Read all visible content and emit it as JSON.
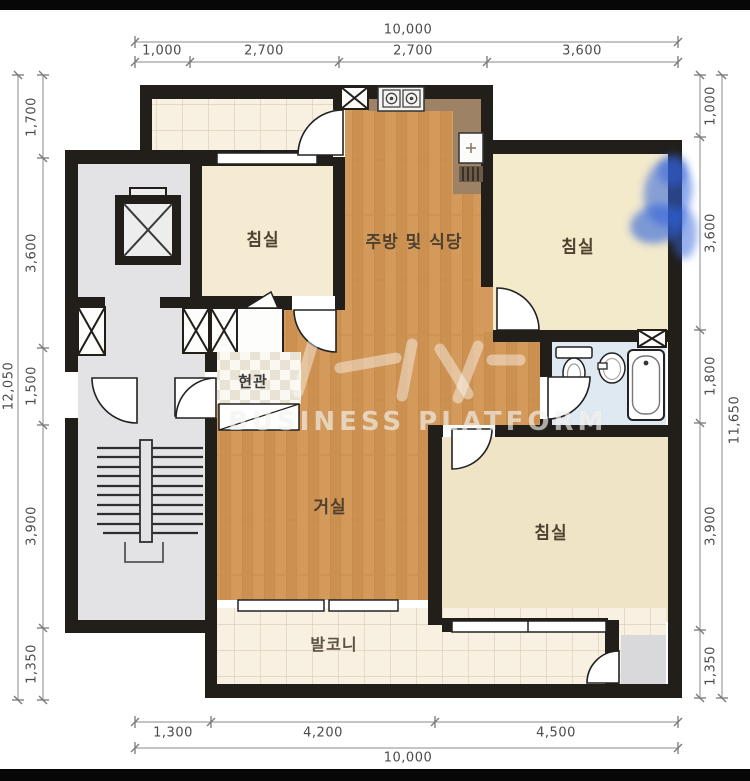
{
  "plan": {
    "rooms": {
      "bedroom_top_left": "침실",
      "bedroom_top_right": "침실",
      "bedroom_bottom_right": "침실",
      "kitchen": "주방 및 식당",
      "entrance": "현관",
      "living": "거실",
      "balcony": "발코니"
    },
    "watermark": "BUSINESS PLATFORM",
    "colors": {
      "wall": "#221e1a",
      "wood_floor": "#d49a5b",
      "bedroom_floor": "#f4ebd2",
      "balcony_tile": "#f8f1e2",
      "bath_floor": "#dfe9f1",
      "corridor": "#e3e3e5",
      "counter": "#9d8266",
      "annotation_blue": "#2f62dc"
    }
  },
  "dimensions": {
    "top": {
      "total": "10,000",
      "segments": [
        "1,000",
        "2,700",
        "2,700",
        "3,600"
      ]
    },
    "left": {
      "total": "12,050",
      "segments": [
        "1,700",
        "3,600",
        "1,500",
        "3,900",
        "1,350"
      ]
    },
    "right": {
      "total": "11,650",
      "segments": [
        "1,000",
        "3,600",
        "1,800",
        "3,900",
        "1,350"
      ]
    },
    "bottom": {
      "total": "10,000",
      "segments": [
        "1,300",
        "4,200",
        "4,500"
      ]
    }
  }
}
